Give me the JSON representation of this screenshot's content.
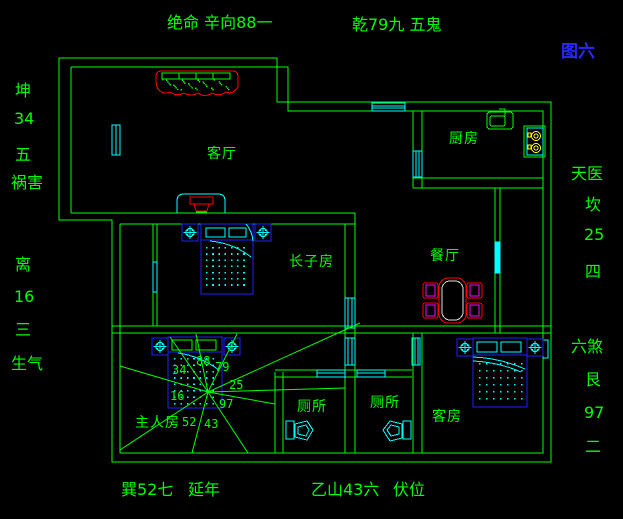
{
  "figure_label": "图六",
  "top_labels": {
    "left": "绝命 辛向88一",
    "right": "乾79九 五鬼"
  },
  "left_labels": [
    "坤",
    "34",
    "五",
    "祸害",
    "离",
    "16",
    "三",
    "生气"
  ],
  "right_labels": [
    "天医",
    "坎",
    "25",
    "四",
    "六煞",
    "艮",
    "97",
    "二"
  ],
  "bottom_labels": [
    "巽52七",
    "延年",
    "乙山43六",
    "伏位"
  ],
  "rooms": {
    "living_room": "客厅",
    "kitchen": "厨房",
    "eldest_son_room": "长子房",
    "dining_room": "餐厅",
    "master_bedroom": "主人房",
    "toilet_1": "厕所",
    "toilet_2": "厕所",
    "guest_room": "客房"
  },
  "compass_numbers": [
    "34",
    "88",
    "79",
    "25",
    "16",
    "97",
    "52",
    "43"
  ],
  "colors": {
    "line_green": "#00ff00",
    "accent_cyan": "#00ffff",
    "accent_blue": "#2020ff",
    "accent_red": "#ff0000",
    "accent_magenta": "#ff00ff",
    "accent_yellow": "#ffff00",
    "table_inner": "#e0e0e0",
    "background": "#000000"
  }
}
